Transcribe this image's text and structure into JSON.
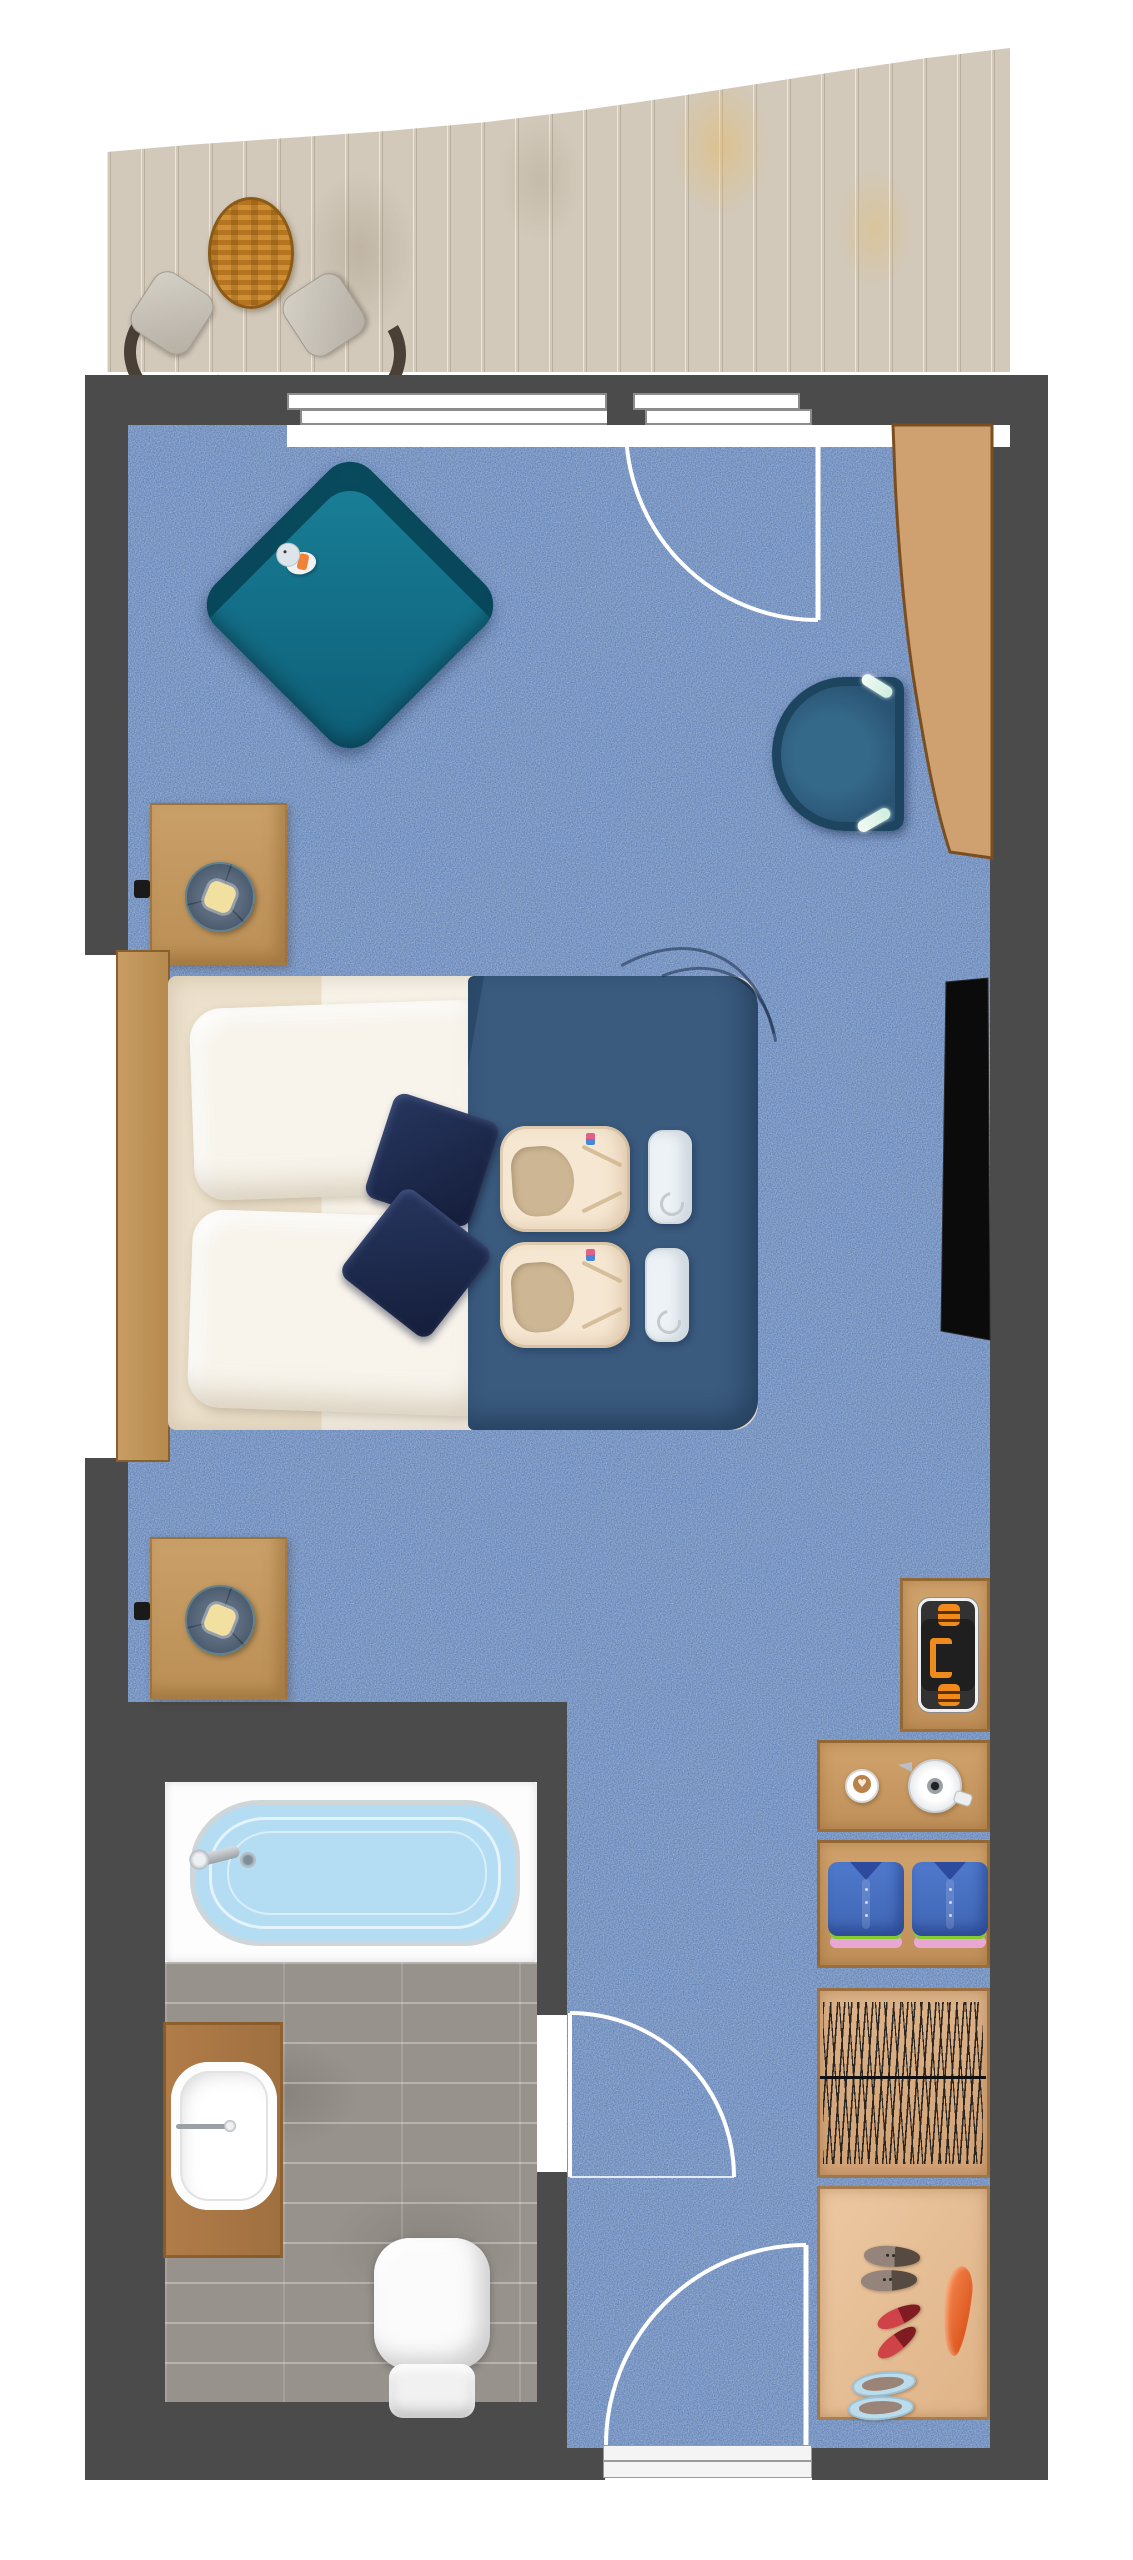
{
  "meta": {
    "title": "Hotel guest room floor plan",
    "view": "top-down 2D rendered floor plan",
    "width_px": 1133,
    "height_px": 2560
  },
  "palette": {
    "wall": "#4b4b4b",
    "carpet": "#4a70ac",
    "carpet-speckle": "#b3c6ea",
    "carpet-mottle": "#1b2f59",
    "deck": "#d2c9ba",
    "chair-back": "#4a4038",
    "wood": "#c49a62",
    "wood-border": "#8a5f2e",
    "armchair": "#14718a",
    "duvet": "#3a5a7e",
    "cushion": "#1d2b50",
    "robe": "#f6e7d2",
    "robe-inner": "#cdb694",
    "lamp-bulb": "#f2e0a0",
    "tub-water": "#9fcdeb",
    "tile": "#98928c",
    "strap": "#ef8a1c",
    "shirt-dark": "#2e4a9e",
    "green": "#84cc2e",
    "pink": "#e9a8d4",
    "slipper": "#bcdcec",
    "door-line": "#ffffff",
    "tv": "#0b0b0b",
    "desk": "#cfa070"
  },
  "areas": {
    "balcony": {
      "label": "Balcony terrace with wood decking"
    },
    "bedroom": {
      "label": "Bedroom with blue carpet"
    },
    "bathroom": {
      "label": "Bathroom with stone tile floor"
    },
    "hallway": {
      "label": "Entry hallway"
    },
    "wardrobe": {
      "label": "Wardrobe and shoe closet"
    }
  },
  "items": {
    "deck": {
      "label": "Curved balcony wood deck"
    },
    "balcony_table": {
      "label": "Round slatted terrace table"
    },
    "balcony_chair_left": {
      "label": "Terrace chair (left)"
    },
    "balcony_chair_right": {
      "label": "Terrace chair (right)"
    },
    "sliding_door": {
      "label": "Sliding glass balcony door",
      "panels": 2
    },
    "balcony_door": {
      "label": "Hinged balcony door shown open with swing arc"
    },
    "armchair": {
      "label": "Teal lounge armchair, rotated 45°"
    },
    "plush_toy": {
      "label": "Plush elephant toy on armchair"
    },
    "desk": {
      "label": "Built-in curved wooden desk"
    },
    "desk_chair": {
      "label": "D-shaped desk chair"
    },
    "tv": {
      "label": "Wall-mounted flat-screen TV"
    },
    "nightstand_top": {
      "label": "Nightstand with round reading lamp"
    },
    "nightstand_bottom": {
      "label": "Nightstand with round reading lamp"
    },
    "outlet": {
      "label": "Wall outlet / switch",
      "count": 2
    },
    "bed": {
      "label": "Double bed with headboard"
    },
    "pillow": {
      "label": "White pillow",
      "count": 2
    },
    "cushion": {
      "label": "Navy accent cushion",
      "count": 2
    },
    "duvet": {
      "label": "Blue duvet with seam folds"
    },
    "bathrobe": {
      "label": "Folded cream bathrobe on bed",
      "count": 2
    },
    "towel_roll": {
      "label": "Rolled white towel on bed",
      "count": 2
    },
    "luggage_rack": {
      "label": "Folding luggage rack with orange straps"
    },
    "coffee_cup": {
      "label": "Coffee cup with latte art"
    },
    "kettle": {
      "label": "Electric kettle on counter"
    },
    "folded_shirt": {
      "label": "Folded blue shirt stack",
      "count": 2
    },
    "hanger_rail": {
      "label": "Closet rail with hangers"
    },
    "loafers": {
      "label": "Pair of gray loafers"
    },
    "flats": {
      "label": "Pair of red flats"
    },
    "slippers": {
      "label": "Pair of light-blue slippers"
    },
    "shoehorn": {
      "label": "Orange shoehorn"
    },
    "bathtub": {
      "label": "Filled bathtub with faucet and drain"
    },
    "vanity_sink": {
      "label": "Vanity counter with white sink"
    },
    "toilet": {
      "label": "Toilet"
    },
    "bathroom_door": {
      "label": "Bathroom door swing arc"
    },
    "entry_door": {
      "label": "Entry door swing arc"
    },
    "threshold": {
      "label": "Entry door threshold"
    }
  }
}
